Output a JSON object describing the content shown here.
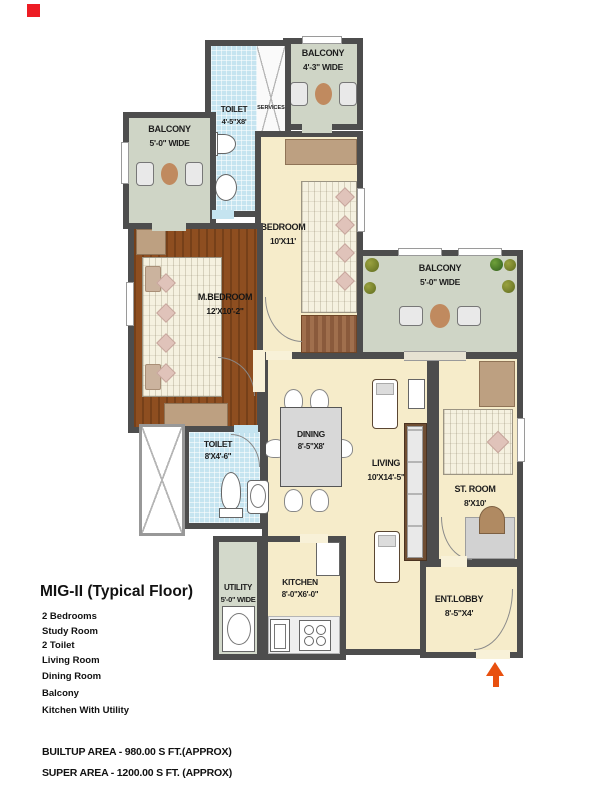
{
  "colors": {
    "wall": "#4d4d4d",
    "floor_cream": "#f6ecca",
    "floor_brown": "#8e4e20",
    "tile_blue": "#c5e4f0",
    "balcony_green": "#cfd5c6",
    "accent_orange": "#e8500f",
    "marker_red": "#ed1c24"
  },
  "rooms": {
    "balcony_top": {
      "name": "BALCONY",
      "dims": "4'-3\" WIDE"
    },
    "toilet_top": {
      "name": "TOILET",
      "dims": "4'-5\"X8'"
    },
    "services": {
      "name": "SERVICES"
    },
    "balcony_left": {
      "name": "BALCONY",
      "dims": "5'-0\" WIDE"
    },
    "bedroom": {
      "name": "BEDROOM",
      "dims": "10'X11'"
    },
    "m_bedroom": {
      "name": "M.BEDROOM",
      "dims": "12'X10'-2\""
    },
    "balcony_right": {
      "name": "BALCONY",
      "dims": "5'-0\" WIDE"
    },
    "dining": {
      "name": "DINING",
      "dims": "8'-5\"X8'"
    },
    "living": {
      "name": "LIVING",
      "dims": "10'X14'-5\""
    },
    "st_room": {
      "name": "ST. ROOM",
      "dims": "8'X10'"
    },
    "toilet_mid": {
      "name": "TOILET",
      "dims": "8'X4'-6\""
    },
    "utility": {
      "name": "UTILITY",
      "dims": "5'-0\" WIDE"
    },
    "kitchen": {
      "name": "KITCHEN",
      "dims": "8'-0\"X6'-0\""
    },
    "ent_lobby": {
      "name": "ENT.LOBBY",
      "dims": "8'-5\"X4'"
    }
  },
  "legend": {
    "heading": "MIG-II (Typical Floor)",
    "features": [
      "2 Bedrooms",
      "Study Room",
      "2 Toilet",
      "Living Room",
      "Dining Room",
      "Balcony",
      "Kitchen With Utility"
    ],
    "areas": [
      "BUILTUP AREA - 980.00 S FT.(APPROX)",
      "SUPER AREA - 1200.00 S FT. (APPROX)"
    ]
  }
}
